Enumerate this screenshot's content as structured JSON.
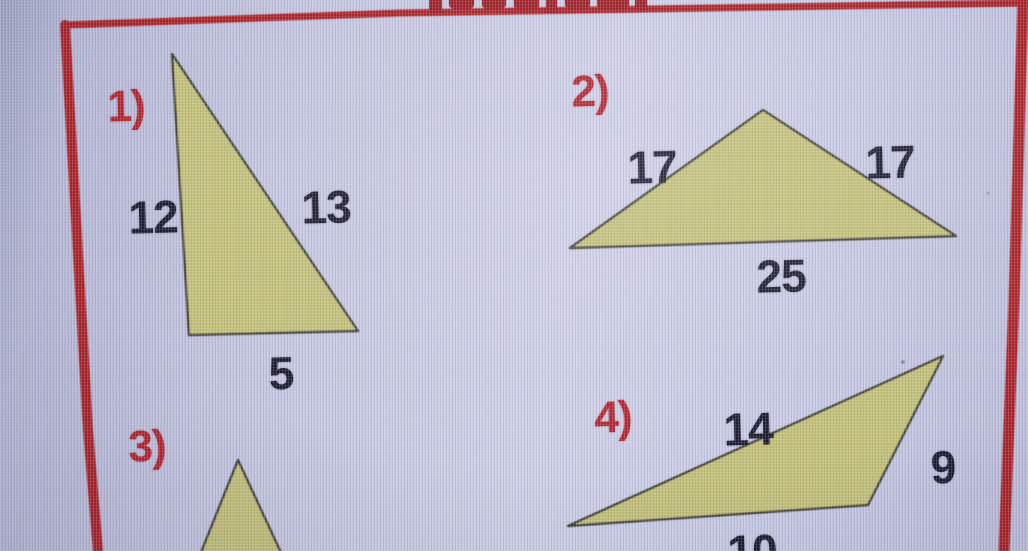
{
  "worksheet": {
    "frame": "red rectangular border, bottom edge cropped off-screen",
    "problems": [
      {
        "number": "1)",
        "shape": "tall right-leaning triangle",
        "labels": {
          "left": "12",
          "right": "13",
          "bottom": "5"
        }
      },
      {
        "number": "2)",
        "shape": "wide isosceles triangle",
        "labels": {
          "left": "17",
          "right": "17",
          "bottom": "25"
        }
      },
      {
        "number": "3)",
        "shape": "triangle cropped at bottom edge",
        "labels": {}
      },
      {
        "number": "4)",
        "shape": "obtuse triangle",
        "labels": {
          "top": "14",
          "right": "9",
          "bottom": "10"
        }
      }
    ]
  },
  "colors": {
    "background": "#c3c4de",
    "frame_red": "#a92026",
    "triangle_fill": "#c7c478",
    "triangle_stroke": "#3d3d34",
    "label_dark": "#1a1a2e",
    "label_red": "#b2232c"
  }
}
